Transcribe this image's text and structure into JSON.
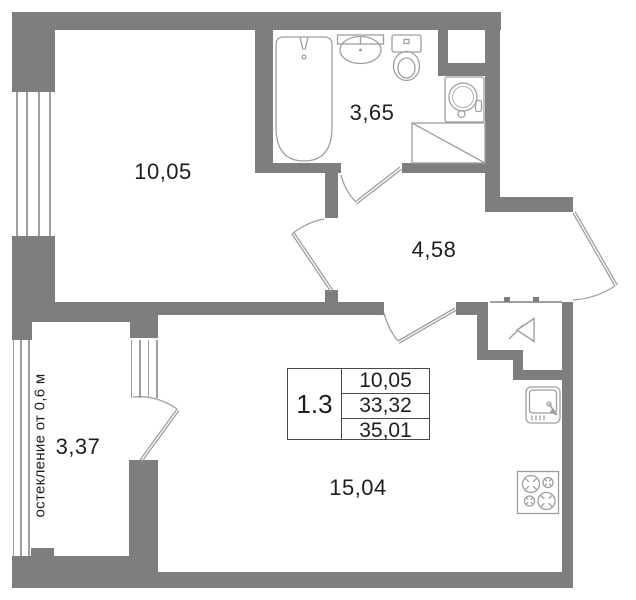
{
  "plan": {
    "area_table": {
      "unit": "1.3",
      "values": [
        "10,05",
        "33,32",
        "35,01"
      ]
    },
    "rooms": {
      "bedroom": "10,05",
      "bathroom": "3,65",
      "hallway": "4,58",
      "balcony": "3,37",
      "living_kitchen": "15,04"
    },
    "glazing_note": "остекление от 0,6 м",
    "fixtures": {
      "bathtub": "bathtub",
      "washbasin": "washbasin",
      "toilet": "toilet",
      "washer": "washing-machine",
      "wardrobe": "wardrobe-with-diagonal",
      "kitchen_sink": "kitchen-sink",
      "stove": "stove-4-burner",
      "entrance": "entrance-arrow"
    },
    "colors": {
      "wall": "#7e7e7e",
      "line": "#9f9f9f",
      "text": "#1e1e1e",
      "table_border": "#4a4a4a"
    }
  }
}
